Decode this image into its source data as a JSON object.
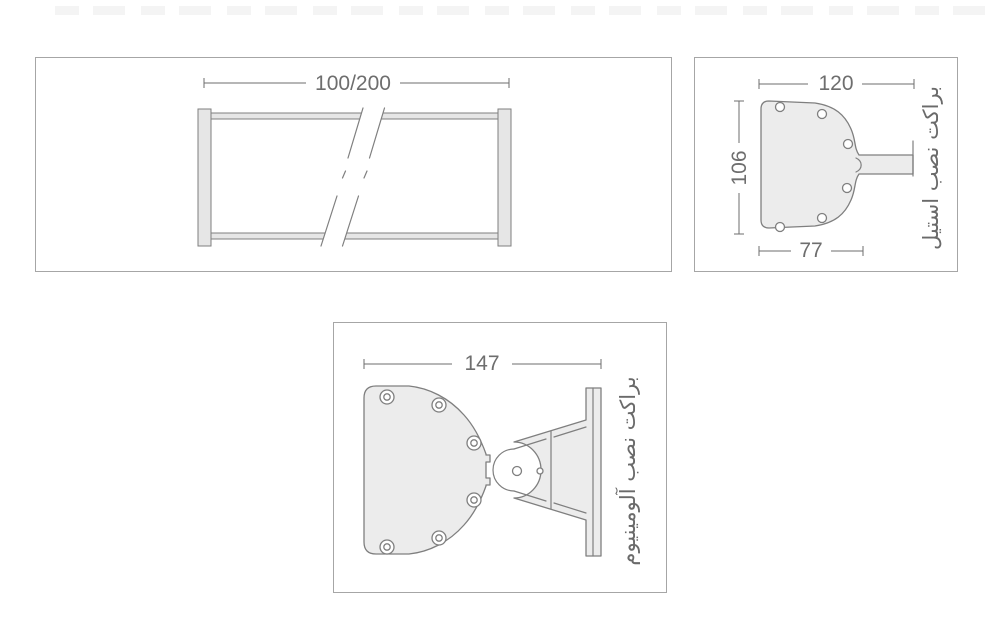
{
  "drawing": {
    "title": "pole mounting brackets technical drawing",
    "colors": {
      "outline": "#7f7f7f",
      "fill": "#ececec",
      "fill-dark": "#e6e6e6",
      "dim": "#6e6e6e",
      "panel-border": "#a6a6a6",
      "label": "#6a6a6a"
    },
    "frame_panel": {
      "dim_length": "100/200"
    },
    "steel_panel": {
      "label": "براکت نصب استیل",
      "dim_top": "120",
      "dim_side": "106",
      "dim_bottom": "77",
      "hole_count": 6
    },
    "aluminum_panel": {
      "label": "براکت نصب آلومینیوم",
      "dim_top": "147",
      "plate_hole_count": 6,
      "gusset_hole_count": 2
    }
  }
}
